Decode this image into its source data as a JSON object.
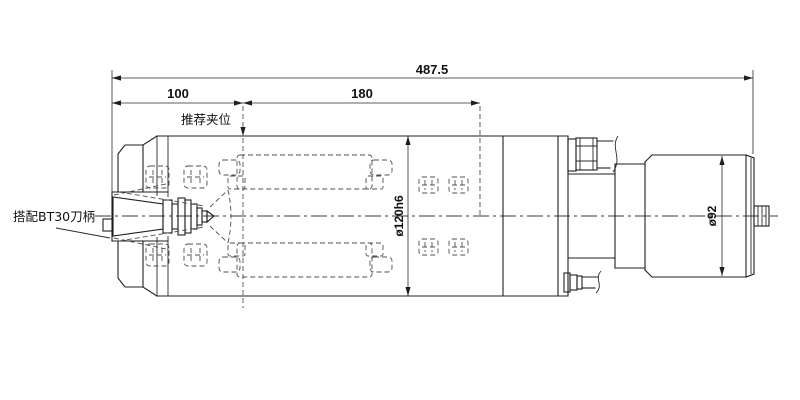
{
  "drawing": {
    "dimensions": {
      "overall_length": "487.5",
      "front_section": "100",
      "mid_section": "180",
      "body_diameter": "ø120h6",
      "rear_diameter": "ø92"
    },
    "annotations": {
      "clamp_area": "推荐夹位",
      "tool_holder": "搭配BT30刀柄"
    },
    "colors": {
      "line": "#1f1f1f",
      "hidden_line": "#4f4f4f",
      "background": "#ffffff"
    }
  }
}
